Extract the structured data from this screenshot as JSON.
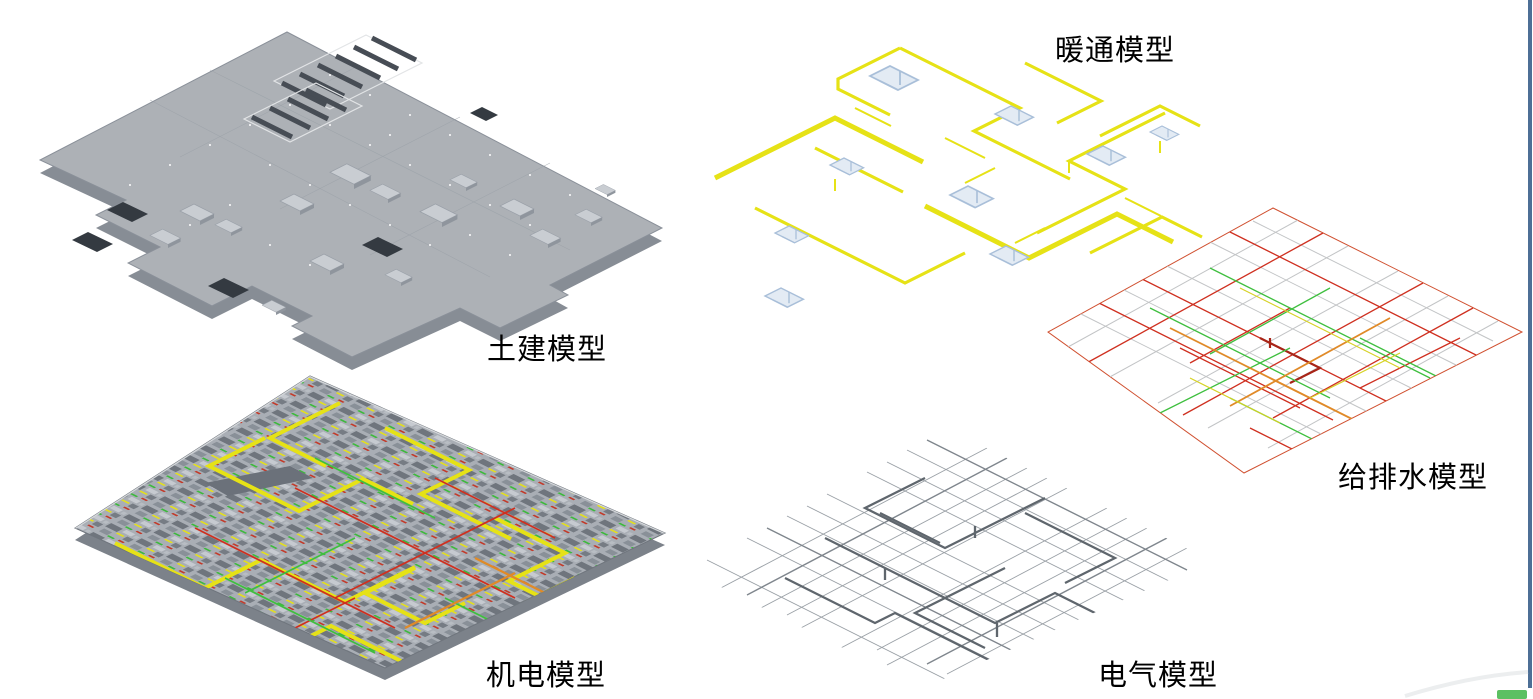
{
  "page": {
    "background": "#ffffff"
  },
  "figure": {
    "panels": [
      {
        "id": "civil",
        "label": "土建模型"
      },
      {
        "id": "mep",
        "label": "机电模型"
      },
      {
        "id": "hvac",
        "label": "暖通模型"
      },
      {
        "id": "plumbing",
        "label": "给排水模型"
      },
      {
        "id": "electrical",
        "label": "电气模型"
      }
    ]
  },
  "colors": {
    "c-yellow": "#e6e216",
    "c-red": "#cf3020",
    "c-darkred": "#a82417",
    "c-green": "#3fbf3f",
    "c-orange": "#e08a28",
    "c-blue": "#a9bfd9",
    "c-blue-fill": "#e3ebf4",
    "c-slab": "#adb1b6",
    "c-slab-side": "#878d95",
    "c-slab-edge": "#8a9099",
    "c-hole": "#343a41",
    "c-grayline": "#c2c4c6",
    "c-elgray": "#9aa0a6",
    "c-eldark": "#5f666d",
    "c-edge-blue": "#4d6f96",
    "c-chip-green": "#5cc062",
    "c-label": "#000000"
  }
}
